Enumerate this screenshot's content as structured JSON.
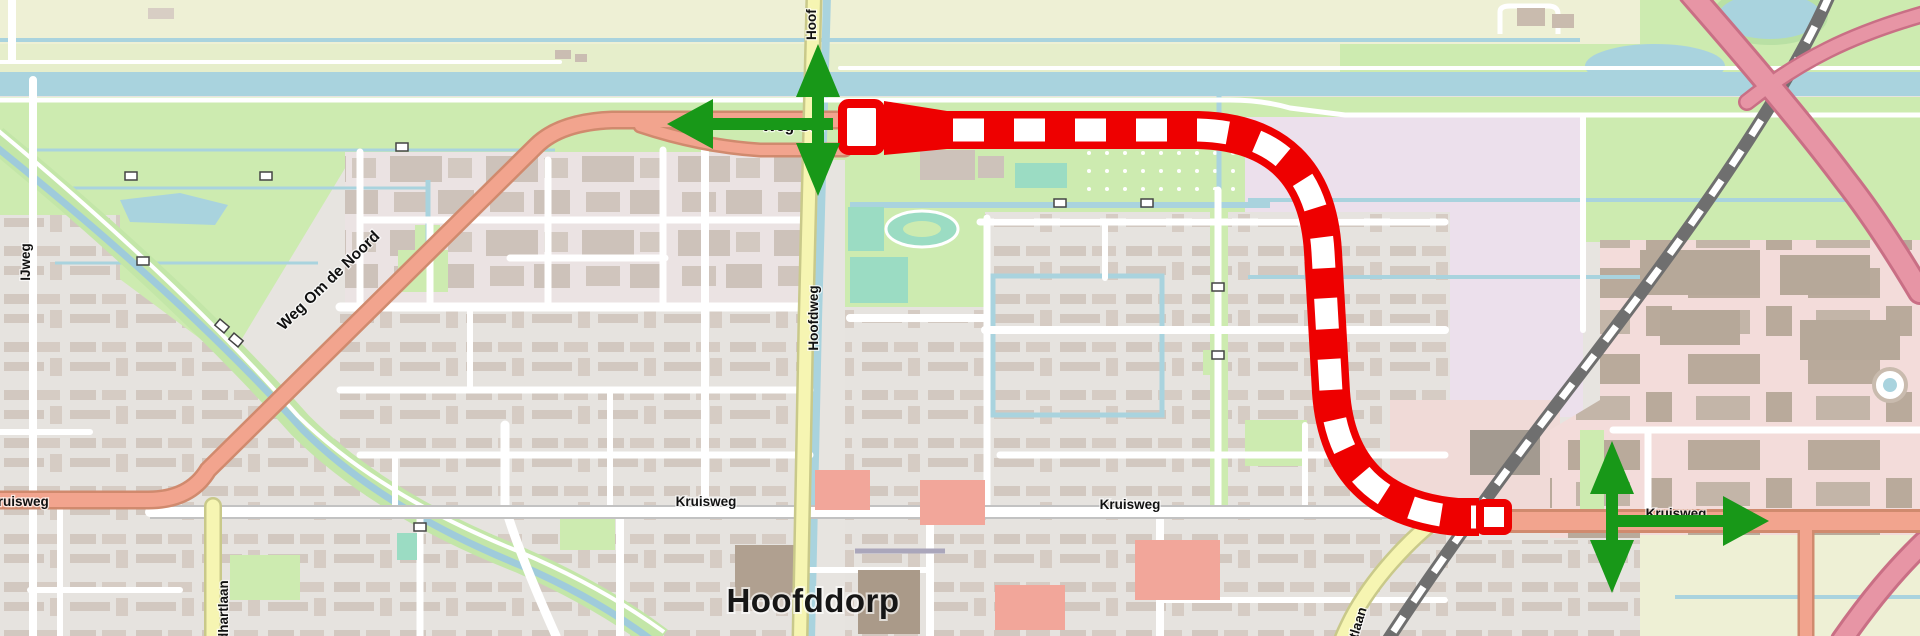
{
  "map": {
    "city_label": "Hoofddorp",
    "road_labels": {
      "hoofdweg_top_fragment": "Hoof",
      "hoofdweg": "Hoofdweg",
      "ijweg": "IJweg",
      "weg_om_de_noord": "Weg Om de Noord",
      "weg_om_fragment": "Weg Om",
      "kruisweg_west": "Kruisweg",
      "kruisweg_center_1": "Kruisweg",
      "kruisweg_center_2": "Kruisweg",
      "kruisweg_east": "Kruisweg",
      "goedhartlaan_fragment": "dhartlaan",
      "laan_fragment": "rtlaan"
    },
    "overlay": {
      "closure_color": "#ee0000",
      "closure_dash_color": "#ffffff",
      "detour_arrow_color": "#189818",
      "detour_arrows": [
        {
          "id": "detour-arrow-west",
          "direction": "left"
        },
        {
          "id": "detour-arrow-hoofdweg",
          "direction": "up-down"
        },
        {
          "id": "detour-arrow-kruisweg-vertical",
          "direction": "up-down"
        },
        {
          "id": "detour-arrow-east",
          "direction": "right"
        }
      ]
    },
    "colors": {
      "water": "#a9d3de",
      "grass": "#cdebb0",
      "farmland": "#eef0d5",
      "residential_base": "#e7e4e0",
      "industrial_base": "#ebe3e3",
      "lavender_field": "#ece0ec",
      "pink_industrial": "#f3dcda",
      "building": "#cdc2ba",
      "trunk_road": "#f2a48e",
      "secondary_road": "#f6f5b2",
      "motorway": "#e795a5",
      "railway": "#6f6f6f"
    }
  }
}
